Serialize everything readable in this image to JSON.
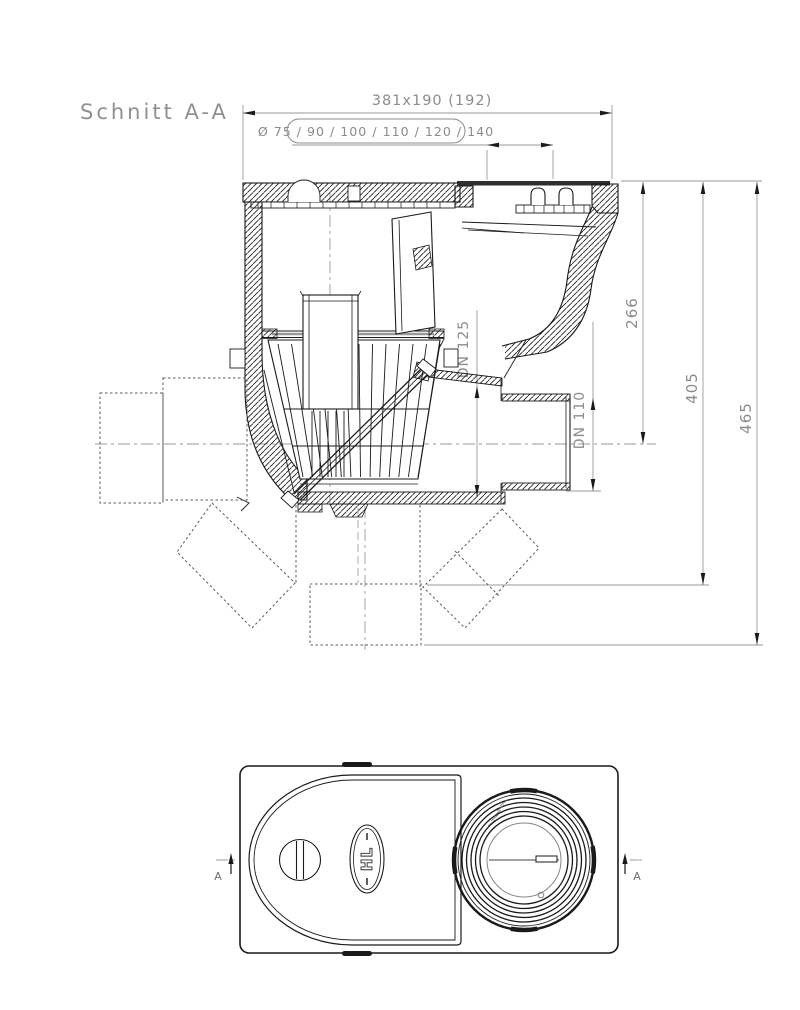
{
  "drawing": {
    "section_label": "Schnitt A-A",
    "section_view": {
      "top_dimension": "381x190  (192)",
      "pipe_diameters_label": "Ø 75 / 90 / 100 / 110 / 120 / 140",
      "vertical_dimensions": {
        "flange_to_outlet_axis": "266",
        "flange_to_angled_outlet": "405",
        "flange_to_vertical_outlet": "465"
      },
      "outlet_socket_label": "DN 125",
      "outlet_spigot_label": "DN 110"
    },
    "plan_view": {
      "section_cut_marker_left": "A",
      "section_cut_marker_right": "A",
      "brand_logo": "HL"
    },
    "colors": {
      "drawing_line": "#1a1a1a",
      "dimension_line": "#9a9a9a",
      "dimension_text": "#8c8c8c",
      "hidden_line": "#5a5a5a"
    }
  }
}
